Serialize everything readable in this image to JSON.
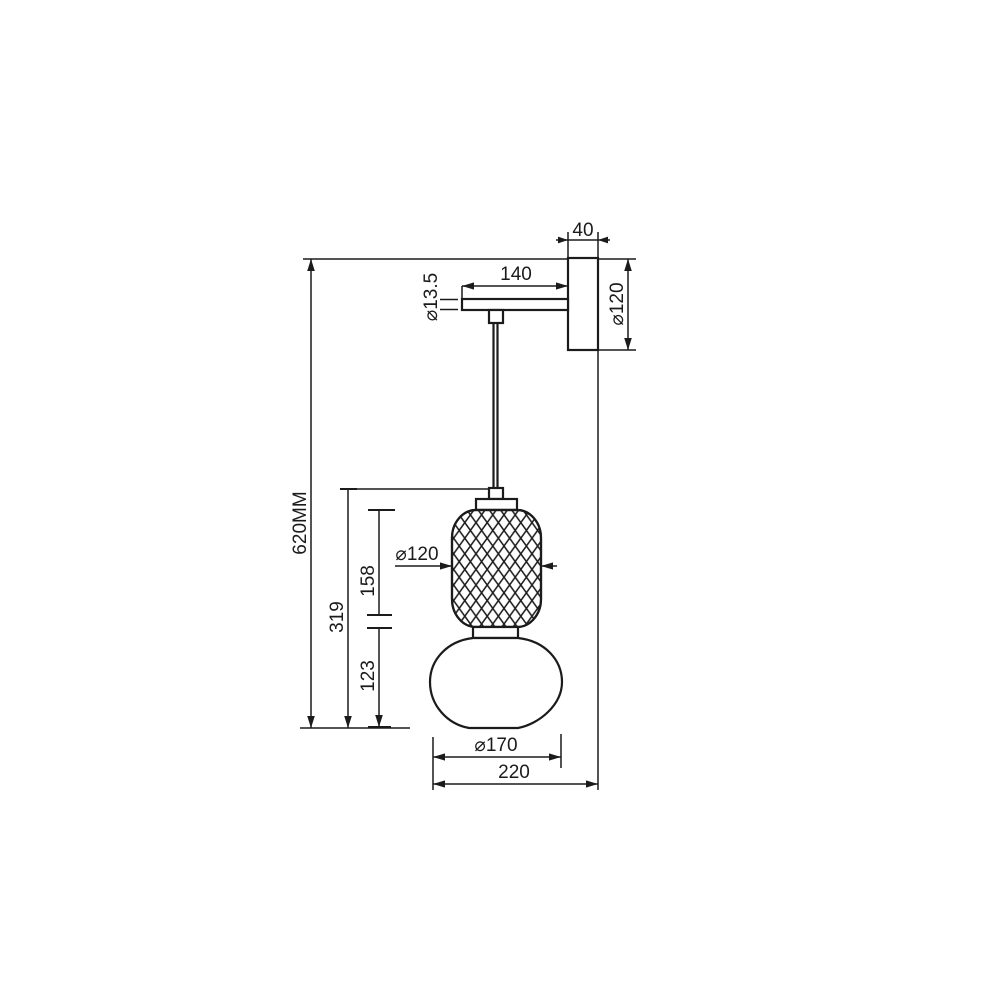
{
  "page": {
    "background": "#ffffff",
    "line_color": "#1b1b1b"
  },
  "drawing": {
    "type": "technical-dimension-drawing",
    "subject": "wall-mounted pendant lamp with diamond-pattern shade",
    "labels": {
      "mount_depth": "40",
      "mount_diameter": "⌀120",
      "arm_length": "140",
      "cord_diameter": "⌀13.5",
      "overall_height": "620MM",
      "drop_height": "319",
      "upper_shade_height": "158",
      "lower_shade_height": "123",
      "upper_shade_diameter": "⌀120",
      "lower_shade_diameter": "⌀170",
      "overall_projection": "220"
    }
  }
}
